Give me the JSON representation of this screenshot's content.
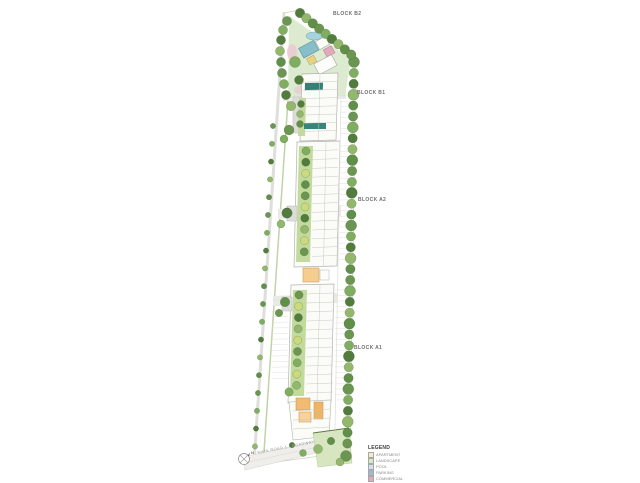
{
  "blocks": [
    {
      "label": "BLOCK B2"
    },
    {
      "label": "BLOCK B1"
    },
    {
      "label": "BLOCK A2"
    },
    {
      "label": "BLOCK A1"
    }
  ],
  "legend": {
    "title": "LEGEND",
    "items": [
      {
        "label": "APARTMENT",
        "color": "#f2edc6"
      },
      {
        "label": "LANDSCAPE",
        "color": "#d8e7c4"
      },
      {
        "label": "POOL",
        "color": "#cfe2ef"
      },
      {
        "label": "PARKING",
        "color": "#9db9d6"
      },
      {
        "label": "COMMERCIAL",
        "color": "#e7a8b4"
      }
    ]
  },
  "road": {
    "label": "MAIN ROAD 1 / ROADWAY"
  },
  "compass": {
    "label": "N"
  },
  "colors": {
    "tree_green_dark": "#527c3d",
    "tree_green_mid": "#6b9550",
    "tree_green_light": "#93b76c",
    "lawn": "#dcead0",
    "planting_strip": "#c3da9e",
    "pool_teal": "#2f8376",
    "amenity_orange": "#f5cd8e",
    "building_fill": "#fbfbf8",
    "road_gray": "#eaeae6"
  }
}
